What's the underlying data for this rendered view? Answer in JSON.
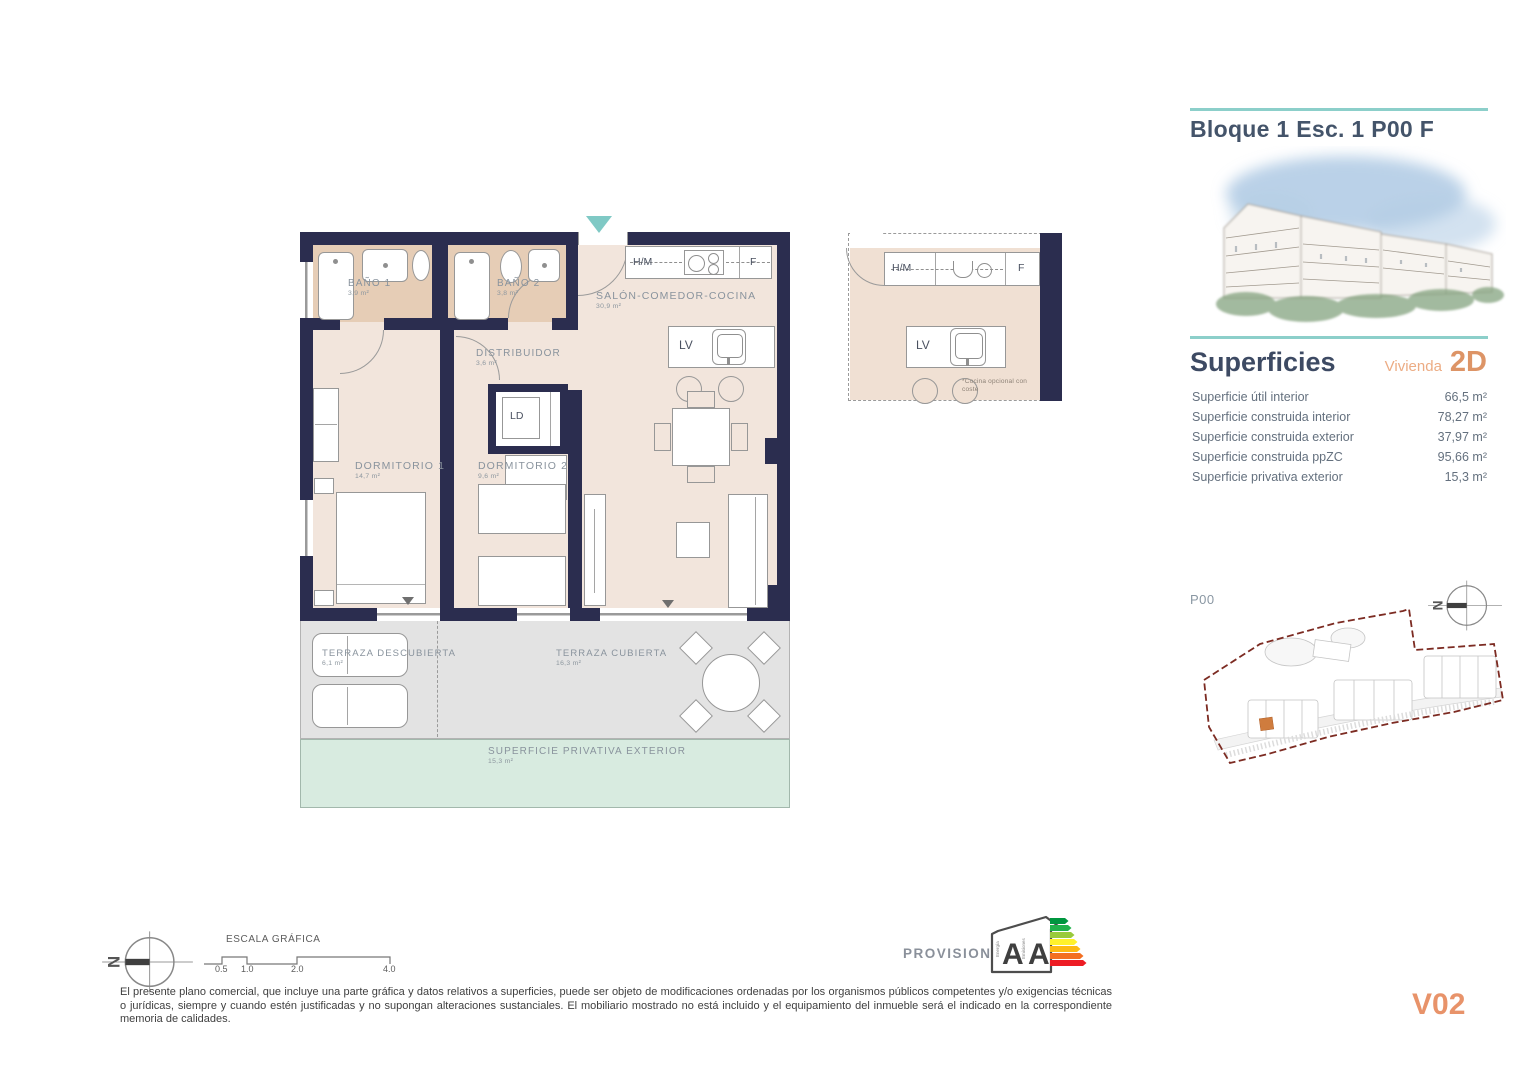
{
  "header": {
    "title": "Bloque 1 Esc. 1 P00 F"
  },
  "superficies": {
    "heading": "Superficies",
    "unit_label": "Vivienda",
    "unit_code": "2D",
    "rows": [
      {
        "label": "Superficie útil interior",
        "value": "66,5 m²"
      },
      {
        "label": "Superficie construida interior",
        "value": "78,27 m²"
      },
      {
        "label": "Superficie construida exterior",
        "value": "37,97 m²"
      },
      {
        "label": "Superficie construida ppZC",
        "value": "95,66 m²"
      },
      {
        "label": "Superficie privativa exterior",
        "value": "15,3 m²"
      }
    ]
  },
  "floorplan": {
    "rooms": {
      "bano1": {
        "name": "BAÑO 1",
        "area": "3,9 m²"
      },
      "bano2": {
        "name": "BAÑO 2",
        "area": "3,8 m²"
      },
      "salon": {
        "name": "SALÓN-COMEDOR-COCINA",
        "area": "30,9 m²"
      },
      "distribuidor": {
        "name": "DISTRIBUIDOR",
        "area": "3,6 m²"
      },
      "dormitorio1": {
        "name": "DORMITORIO 1",
        "area": "14,7 m²"
      },
      "dormitorio2": {
        "name": "DORMITORIO 2",
        "area": "9,6 m²"
      },
      "terraza_descubierta": {
        "name": "TERRAZA DESCUBIERTA",
        "area": "6,1 m²"
      },
      "terraza_cubierta": {
        "name": "TERRAZA CUBIERTA",
        "area": "16,3 m²"
      },
      "privativa_exterior": {
        "name": "SUPERFICIE PRIVATIVA EXTERIOR",
        "area": "15,3 m²"
      }
    },
    "fixtures": {
      "hm": "H/M",
      "fridge": "F",
      "dishwasher": "LV",
      "laundry": "LD"
    },
    "kitchen_detail_note": "*Cocina opcional con coste"
  },
  "siteplan": {
    "floor_label": "P00"
  },
  "compass": {
    "north": "N"
  },
  "scalebar": {
    "title": "ESCALA GRÁFICA",
    "ticks": [
      "0.5",
      "1.0",
      "2.0",
      "4.0"
    ]
  },
  "energy": {
    "status": "PROVISIONAL",
    "energia_label": "Energía",
    "emisiones_label": "Emisiones",
    "energia_rating": "A",
    "emisiones_rating": "A"
  },
  "footer": {
    "disclaimer": "El presente plano comercial, que incluye una parte gráfica y datos relativos a superficies, puede ser objeto de modificaciones ordenadas por los organismos públicos competentes y/o exigencias técnicas o jurídicas, siempre y cuando estén justificadas y no supongan alteraciones sustanciales. El mobiliario mostrado no está incluido y el equipamiento del inmueble será el indicado en la correspondiente memoria de calidades.",
    "version": "V02"
  },
  "colors": {
    "wall": "#2b2d4f",
    "interior_floor": "#f2e5dc",
    "bathroom_floor": "#e6cdb6",
    "terrace": "#e3e3e3",
    "private_exterior": "#d8ebe0",
    "teal_accent": "#8ccfca",
    "entry_marker": "#7fc9c5",
    "orange_accent": "#dd9466",
    "title_slate": "#44546a",
    "site_boundary": "#7c2b22",
    "highlight_unit": "#cf7c3e"
  }
}
